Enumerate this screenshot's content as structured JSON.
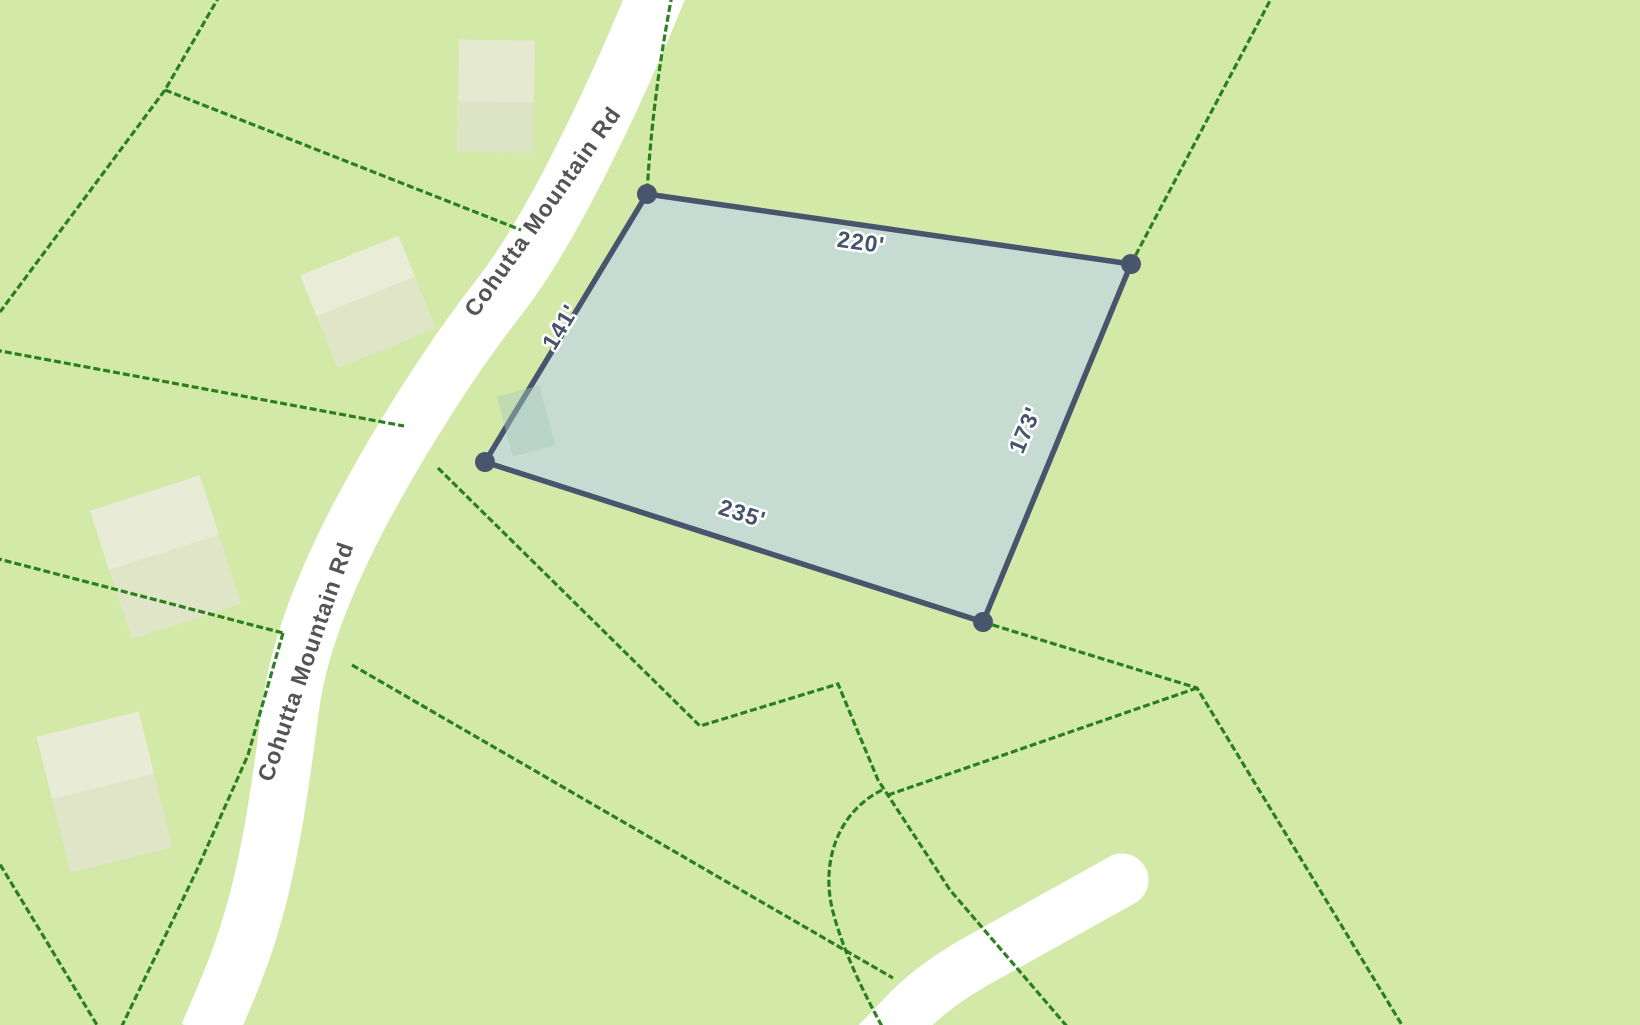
{
  "map": {
    "background_color": "#d3e9a8",
    "boundary_line_color": "#217a14",
    "road_color": "#ffffff",
    "roads": [
      {
        "name": "Cohutta Mountain Rd"
      }
    ],
    "road_labels": [
      {
        "text": "Cohutta Mountain Rd",
        "position": "upper"
      },
      {
        "text": "Cohutta Mountain Rd",
        "position": "lower"
      }
    ],
    "parcel": {
      "fill_color": "#c6dcd2",
      "stroke_color": "#48556c",
      "vertex_color": "#48556c",
      "vertices_px": [
        [
          647,
          194
        ],
        [
          1131,
          264
        ],
        [
          983,
          622
        ],
        [
          485,
          462
        ]
      ],
      "dimensions": [
        {
          "label": "220'",
          "feet": 220,
          "side": "north"
        },
        {
          "label": "141'",
          "feet": 141,
          "side": "west"
        },
        {
          "label": "173'",
          "feet": 173,
          "side": "east"
        },
        {
          "label": "235'",
          "feet": 235,
          "side": "south"
        }
      ]
    },
    "buildings_color": "#e0e5c6"
  }
}
